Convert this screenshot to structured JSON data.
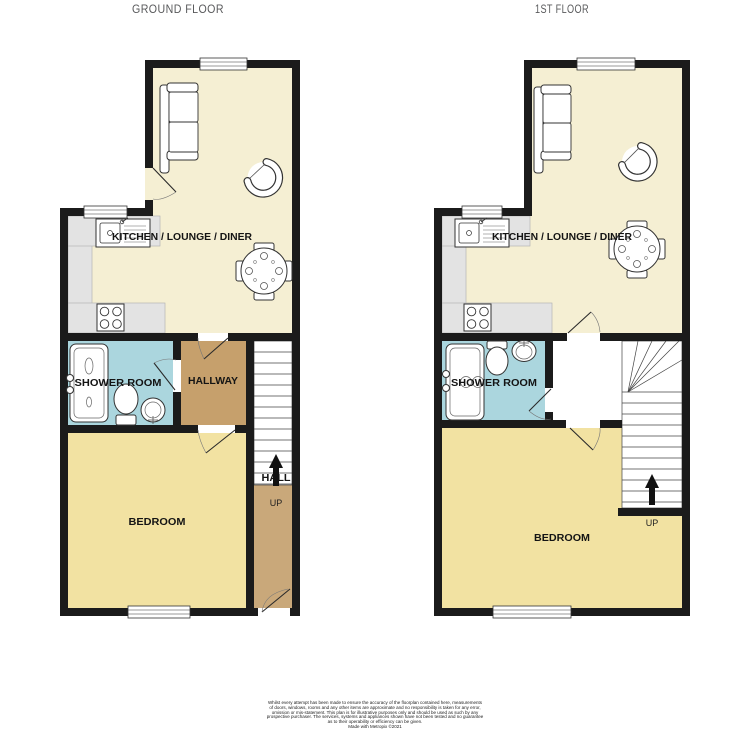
{
  "ground": {
    "title": "GROUND FLOOR",
    "rooms": {
      "kitchen": "KITCHEN / LOUNGE / DINER",
      "shower": "SHOWER ROOM",
      "hallway": "HALLWAY",
      "bedroom": "BEDROOM",
      "hall": "HALL",
      "up": "UP"
    }
  },
  "first": {
    "title": "1ST FLOOR",
    "rooms": {
      "kitchen": "KITCHEN / LOUNGE / DINER",
      "shower": "SHOWER ROOM",
      "bedroom": "BEDROOM",
      "up": "UP"
    }
  },
  "colors": {
    "wall": "#1b1b1b",
    "kitchen_lounge": "#f5efd3",
    "bedroom": "#f2e2a2",
    "shower_room": "#abd6de",
    "hallway": "#c6a06c",
    "hall": "#c9a87a",
    "counter": "#e3e3e3",
    "landing": "#ffffff"
  },
  "disclaimer": {
    "lines": [
      "Whilst every attempt has been made to ensure the accuracy of the floorplan contained here, measurements",
      "of doors, windows, rooms and any other items are approximate and no responsibility is taken for any error,",
      "omission or mis-statement. This plan is for illustrative purposes only and should be used as such by any",
      "prospective purchaser. The services, systems and appliances shown have not been tested and no guarantee",
      "as to their operability or efficiency can be given.",
      "Made with Metropix ©2021"
    ]
  }
}
